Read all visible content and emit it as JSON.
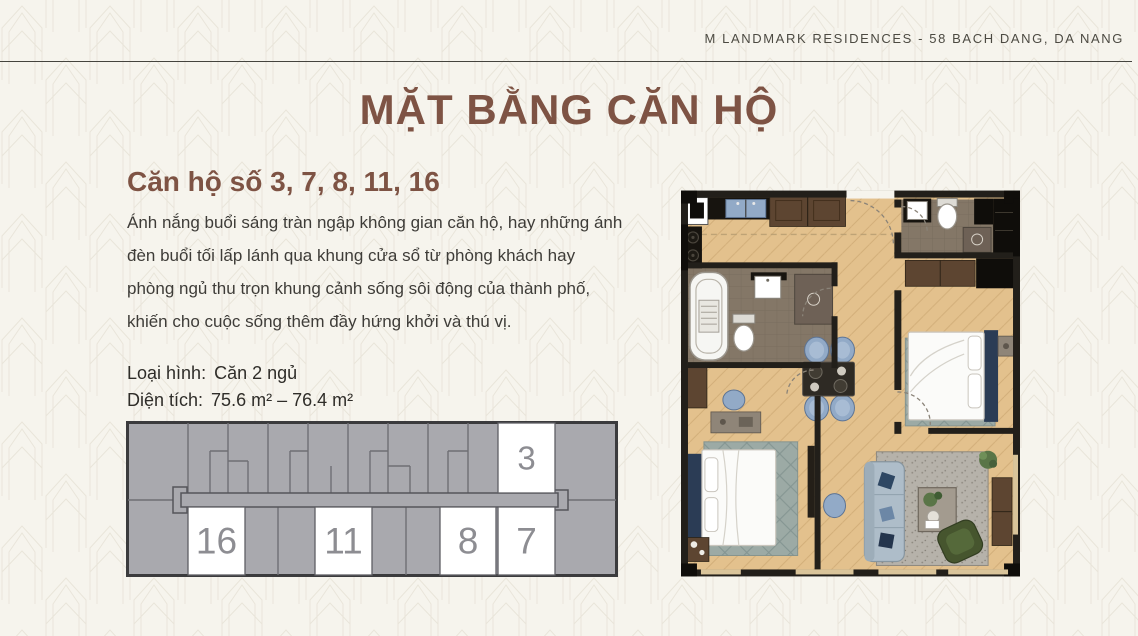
{
  "header": {
    "brand": "M LANDMARK RESIDENCES - 58 BACH DANG, DA NANG"
  },
  "title": "MẶT BẰNG CĂN HỘ",
  "section": {
    "subtitle": "Căn hộ số 3, 7, 8, 11, 16",
    "description": "Ánh nắng buổi sáng tràn ngập không gian căn hộ, hay những ánh đèn buổi tối lấp lánh qua khung cửa sổ từ phòng khách hay phòng ngủ thu trọn khung cảnh sống sôi động của thành phố, khiến cho cuộc sống thêm đầy hứng khởi và thú vị.",
    "specs": [
      {
        "label": "Loại hình:",
        "value": "Căn 2 ngủ"
      },
      {
        "label": "Diện tích:",
        "value": "75.6 m² – 76.4 m²"
      }
    ]
  },
  "key_plan": {
    "highlighted_units": [
      {
        "number": "3",
        "row": "top"
      },
      {
        "number": "16",
        "row": "bottom"
      },
      {
        "number": "11",
        "row": "bottom"
      },
      {
        "number": "8",
        "row": "bottom"
      },
      {
        "number": "7",
        "row": "bottom"
      }
    ]
  },
  "colors": {
    "background": "#f6f4ed",
    "pattern_line": "#e9e5da",
    "heading_brown": "#7e5344",
    "body_text": "#3e3c38",
    "header_text": "#4c4a42",
    "rule_line": "#45443e",
    "keyplan_gray": "#a9a9ae",
    "keyplan_line": "#6f6f74",
    "keyplan_border": "#3b3b3d",
    "keyplan_unit_white": "#ffffff",
    "keyplan_number": "#8d8d92",
    "plan_wall": "#221f1a",
    "plan_floor": "#e3c18d",
    "plan_bath_floor": "#847767",
    "plan_navy": "#2b3c55",
    "plan_blue": "#92aac7",
    "plan_sofa": "#aebdc9",
    "plan_green_chair": "#46552e",
    "plan_window": "#d9c49a"
  }
}
